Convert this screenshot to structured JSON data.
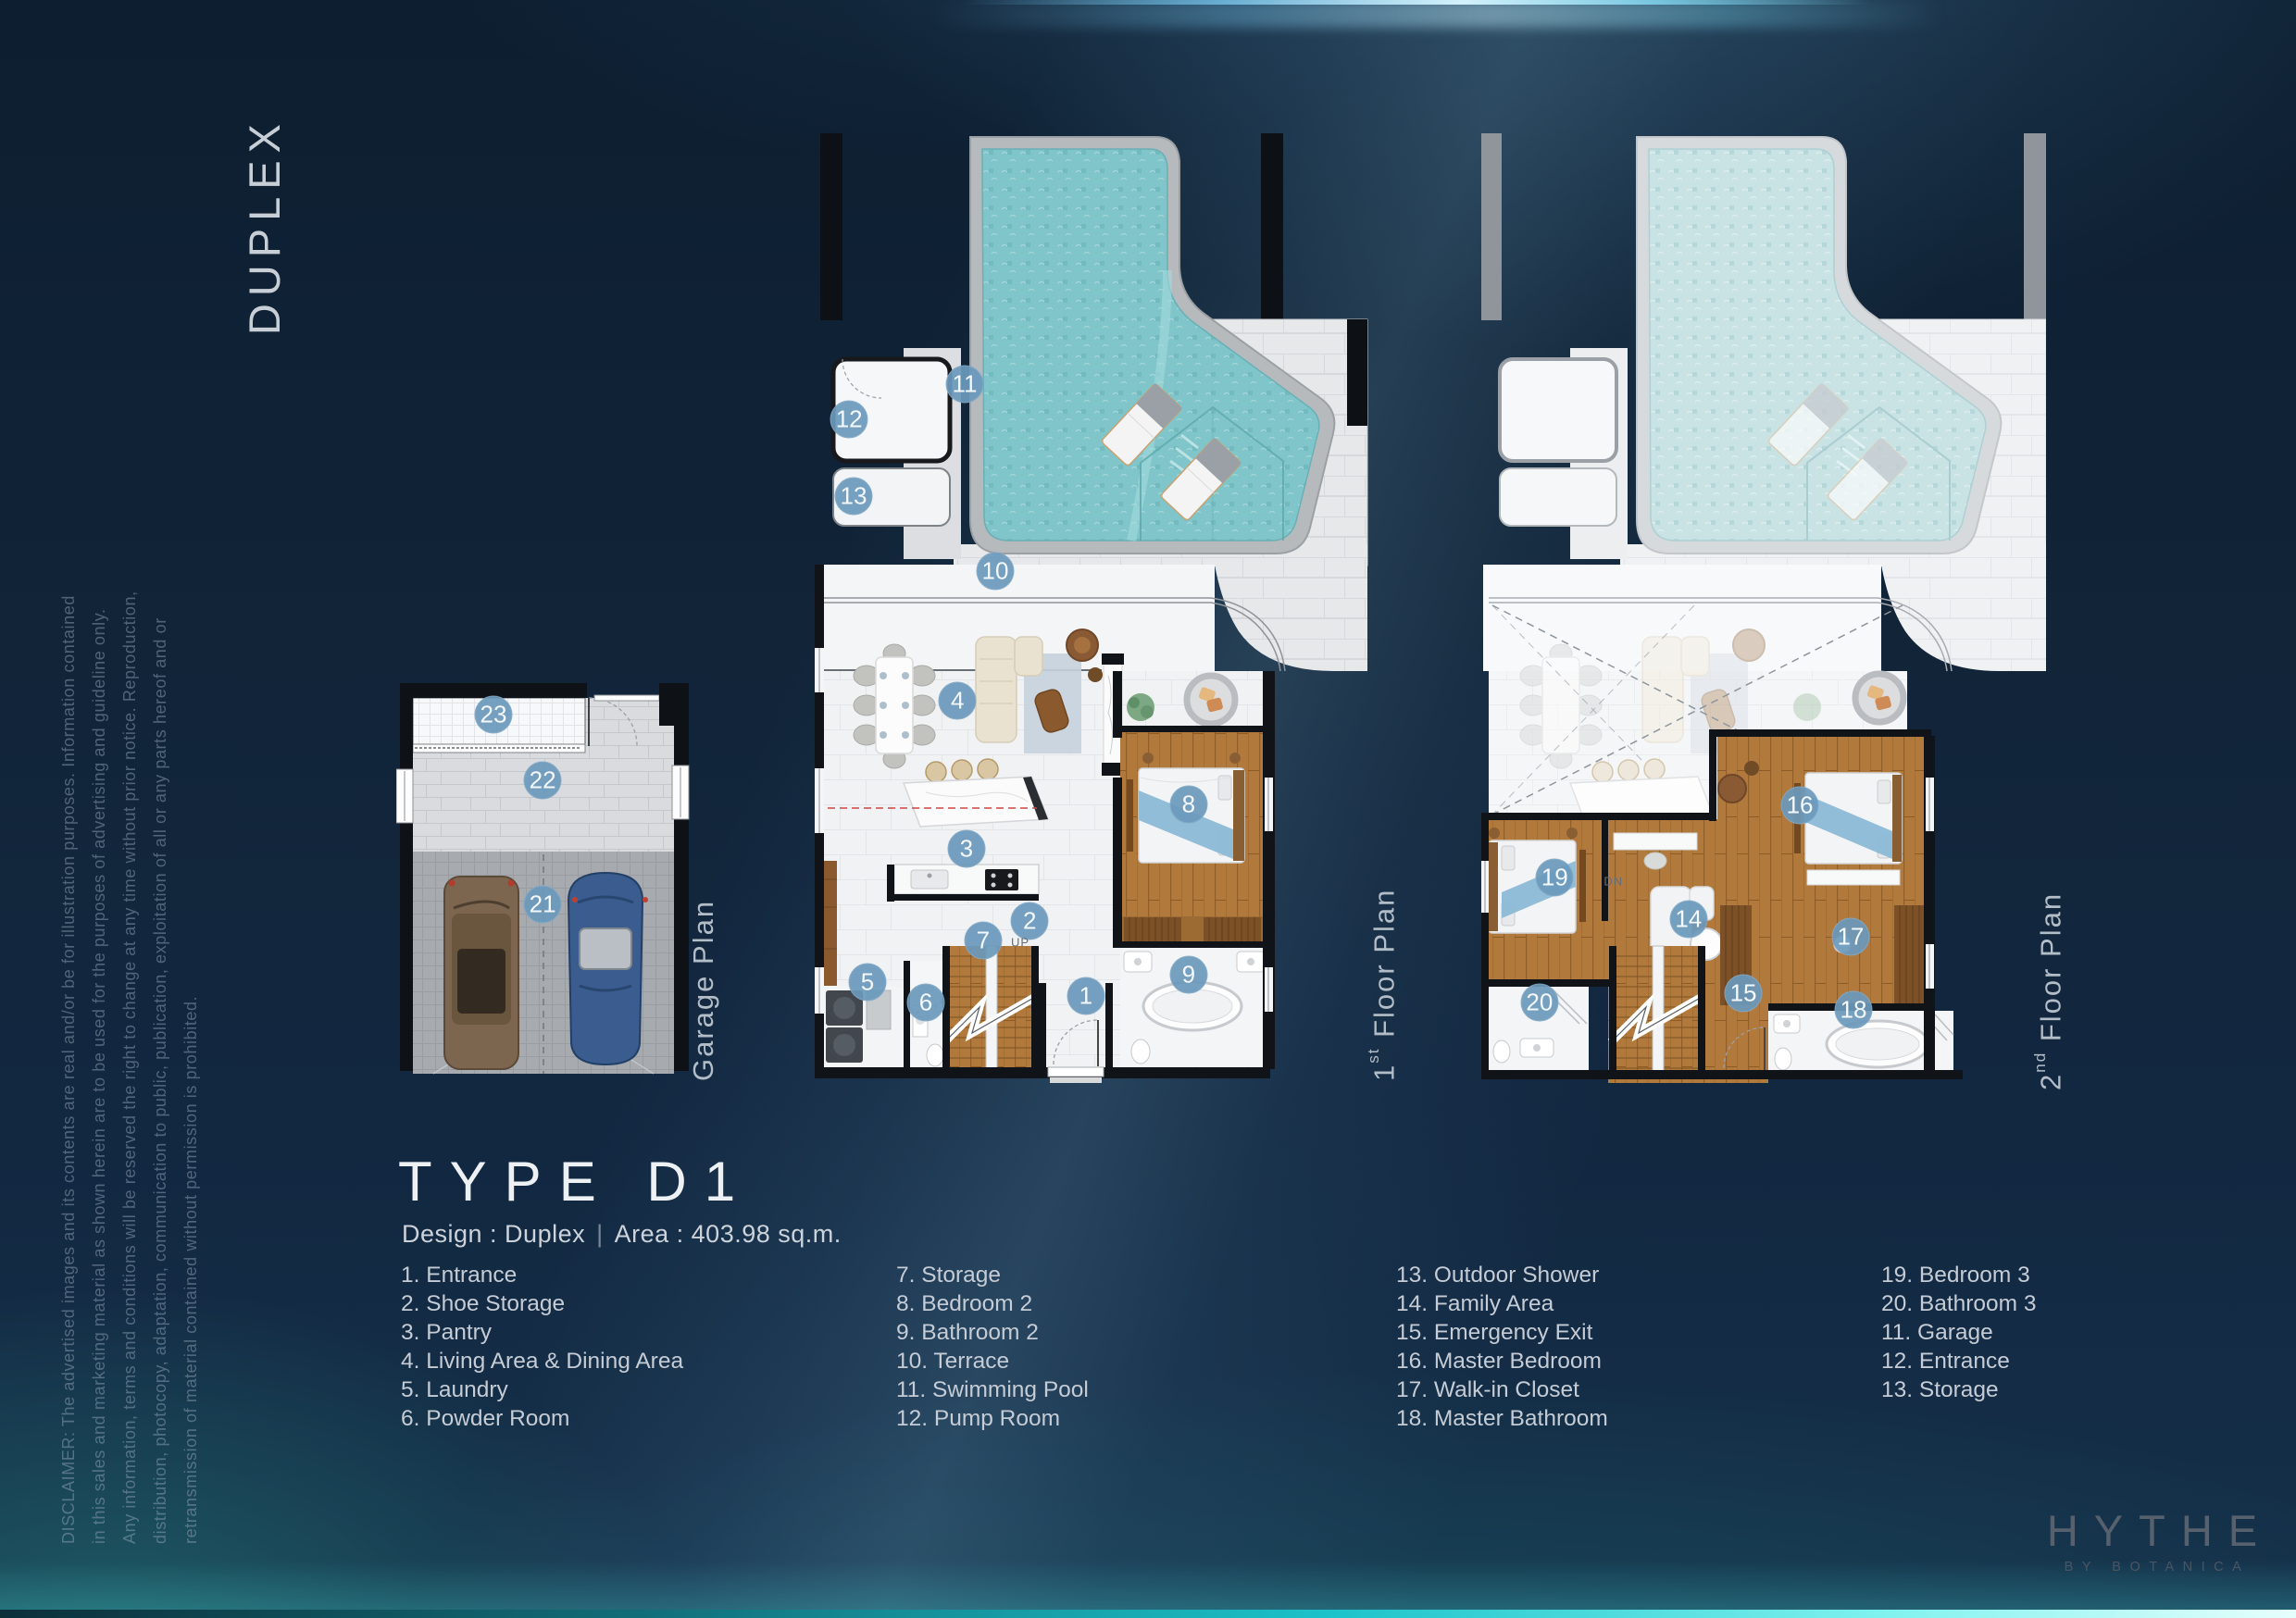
{
  "page": {
    "side_title": "DUPLEX",
    "disclaimer_lines": [
      "DISCLAIMER: The advertised images and its contents are real and/or be for illustration purposes. Information contained",
      "in this sales and marketing material as shown herein are to be used for the purposes of advertising and guideline only.",
      "Any information, terms and conditions will be reserved the right to change at any time without prior notice. Reproduction,",
      "distribution, photocopy, adaptation, communication to public, publication, exploitation of all or any parts hereof and or",
      "retransmission of material contained without permission is prohibited."
    ]
  },
  "type_block": {
    "title": "TYPE D1",
    "design": "Design : Duplex",
    "divider": "|",
    "area": "Area : 403.98 sq.m."
  },
  "plan_labels": {
    "garage": {
      "text": "Garage Plan"
    },
    "first": {
      "num": "1",
      "sup": "st",
      "rest": " Floor Plan"
    },
    "second": {
      "num": "2",
      "sup": "nd",
      "rest": " Floor Plan"
    }
  },
  "markers": {
    "garage": [
      {
        "n": "23",
        "x": 32.8,
        "y": 8.6
      },
      {
        "n": "22",
        "x": 49.4,
        "y": 25.1
      },
      {
        "n": "21",
        "x": 49.4,
        "y": 56.3
      }
    ],
    "first": [
      {
        "n": "11",
        "x": 27.0,
        "y": 26.7
      },
      {
        "n": "12",
        "x": 6.2,
        "y": 30.4
      },
      {
        "n": "13",
        "x": 7.0,
        "y": 38.4
      },
      {
        "n": "10",
        "x": 32.5,
        "y": 46.3
      },
      {
        "n": "4",
        "x": 25.7,
        "y": 59.9
      },
      {
        "n": "8",
        "x": 67.3,
        "y": 70.8
      },
      {
        "n": "3",
        "x": 27.3,
        "y": 75.4
      },
      {
        "n": "2",
        "x": 38.7,
        "y": 83.0
      },
      {
        "n": "7",
        "x": 30.3,
        "y": 85.0
      },
      {
        "n": "5",
        "x": 9.5,
        "y": 89.4
      },
      {
        "n": "6",
        "x": 20.0,
        "y": 91.6
      },
      {
        "n": "1",
        "x": 48.8,
        "y": 90.9
      },
      {
        "n": "9",
        "x": 67.3,
        "y": 88.6
      }
    ],
    "second": [
      {
        "n": "16",
        "x": 56.4,
        "y": 70.9
      },
      {
        "n": "19",
        "x": 13.0,
        "y": 78.4
      },
      {
        "n": "14",
        "x": 36.7,
        "y": 82.8
      },
      {
        "n": "17",
        "x": 65.4,
        "y": 84.7
      },
      {
        "n": "15",
        "x": 46.4,
        "y": 90.6
      },
      {
        "n": "20",
        "x": 10.3,
        "y": 91.6
      },
      {
        "n": "18",
        "x": 65.9,
        "y": 92.3
      }
    ]
  },
  "plan_texts": [
    {
      "plan": "first",
      "text": "UP",
      "x": 37.0,
      "y": 85.2
    },
    {
      "plan": "second",
      "text": "DN",
      "x": 23.4,
      "y": 78.8
    }
  ],
  "legend": {
    "columns": [
      [
        "1. Entrance",
        "2. Shoe Storage",
        "3. Pantry",
        "4. Living Area & Dining Area",
        "5. Laundry",
        "6. Powder Room"
      ],
      [
        "7. Storage",
        "8. Bedroom 2",
        "9. Bathroom 2",
        "10. Terrace",
        "11. Swimming Pool",
        "12. Pump Room"
      ],
      [
        "13. Outdoor Shower",
        "14. Family Area",
        "15. Emergency Exit",
        "16. Master Bedroom",
        "17. Walk-in Closet",
        "18. Master Bathroom"
      ],
      [
        "19. Bedroom 3",
        "20. Bathroom 3",
        "11. Garage",
        "12. Entrance",
        "13. Storage"
      ]
    ]
  },
  "brand": {
    "name": "HYTHE",
    "sub": "BY BOTANICA"
  },
  "colors": {
    "marker": "#6a99bb",
    "pool_water": "#7fc5c9",
    "wood_floor": "#b2793c",
    "background_navy": "#122740",
    "accent_cyan": "#3fd6da"
  }
}
